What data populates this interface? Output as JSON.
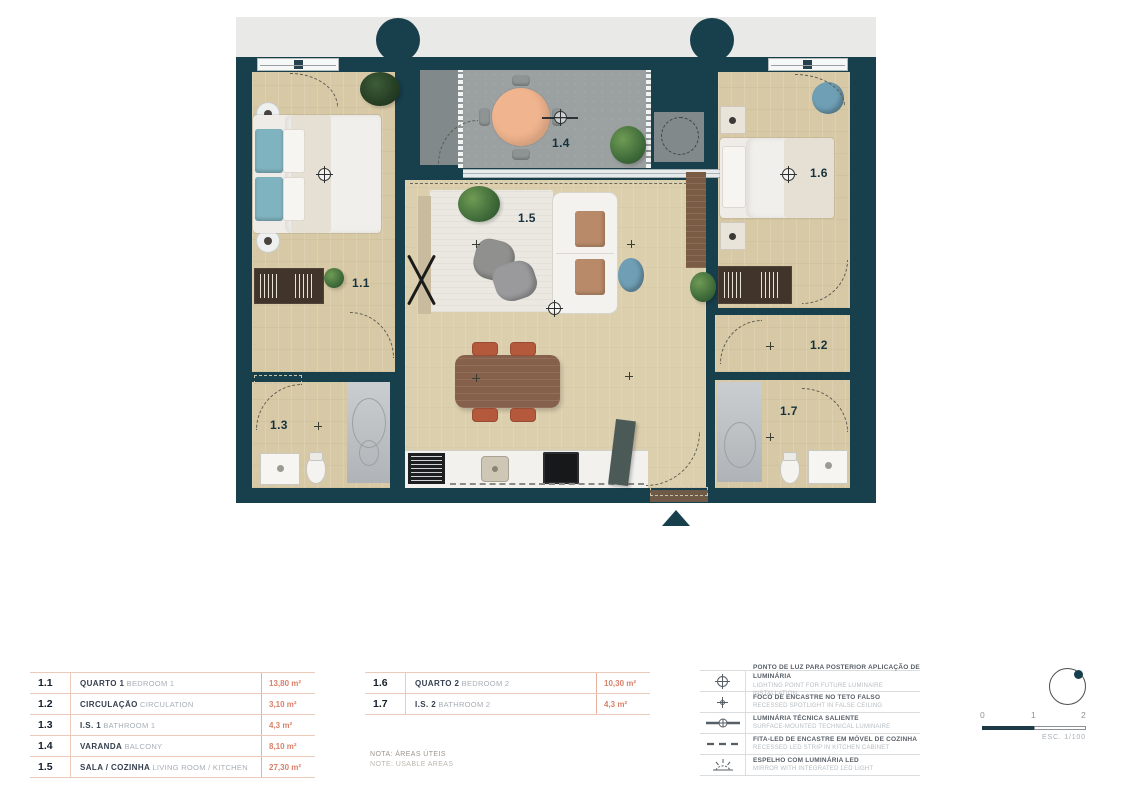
{
  "plan": {
    "room_labels": {
      "bedroom1": "1.1",
      "circulation": "1.2",
      "bathroom1": "1.3",
      "balcony": "1.4",
      "living": "1.5",
      "bedroom2": "1.6",
      "bathroom2": "1.7"
    },
    "colors": {
      "wall": "#183f4c",
      "wood": "#d7c9a5",
      "concrete": "#9ba1a0",
      "accent": "#d9806a"
    }
  },
  "legend": {
    "rooms_left": [
      {
        "num": "1.1",
        "name_pt": "QUARTO 1",
        "name_en": "BEDROOM 1",
        "area": "13,80 m²"
      },
      {
        "num": "1.2",
        "name_pt": "CIRCULAÇÃO",
        "name_en": "CIRCULATION",
        "area": "3,10 m²"
      },
      {
        "num": "1.3",
        "name_pt": "I.S. 1",
        "name_en": "BATHROOM 1",
        "area": "4,3 m²"
      },
      {
        "num": "1.4",
        "name_pt": "VARANDA",
        "name_en": "BALCONY",
        "area": "8,10 m²"
      },
      {
        "num": "1.5",
        "name_pt": "SALA / COZINHA",
        "name_en": "LIVING ROOM / KITCHEN",
        "area": "27,30 m²"
      }
    ],
    "rooms_right": [
      {
        "num": "1.6",
        "name_pt": "QUARTO 2",
        "name_en": "BEDROOM 2",
        "area": "10,30 m²"
      },
      {
        "num": "1.7",
        "name_pt": "I.S. 2",
        "name_en": "BATHROOM 2",
        "area": "4,3 m²"
      }
    ],
    "note_pt": "NOTA: ÁREAS ÚTEIS",
    "note_en": "NOTE: USABLE AREAS",
    "symbols": [
      {
        "icon": "lighting-point",
        "pt": "PONTO DE LUZ PARA POSTERIOR APLICAÇÃO DE LUMINÁRIA",
        "en": "LIGHTING POINT FOR FUTURE LUMINAIRE INSTALLATION"
      },
      {
        "icon": "recessed-spotlight",
        "pt": "FOCO DE ENCASTRE NO TETO FALSO",
        "en": "RECESSED SPOTLIGHT IN FALSE CEILING"
      },
      {
        "icon": "surface-luminaire",
        "pt": "LUMINÁRIA TÉCNICA SALIENTE",
        "en": "SURFACE-MOUNTED TECHNICAL LUMINAIRE"
      },
      {
        "icon": "led-strip",
        "pt": "FITA-LED DE ENCASTRE EM MÓVEL DE COZINHA",
        "en": "RECESSED LED STRIP IN KITCHEN CABINET"
      },
      {
        "icon": "mirror-led",
        "pt": "ESPELHO COM LUMINÁRIA LED",
        "en": "MIRROR WITH INTEGRATED LED LIGHT"
      }
    ]
  },
  "scale": {
    "tick0": "0",
    "tick1": "1",
    "tick2": "2",
    "label": "ESC. 1/100"
  }
}
